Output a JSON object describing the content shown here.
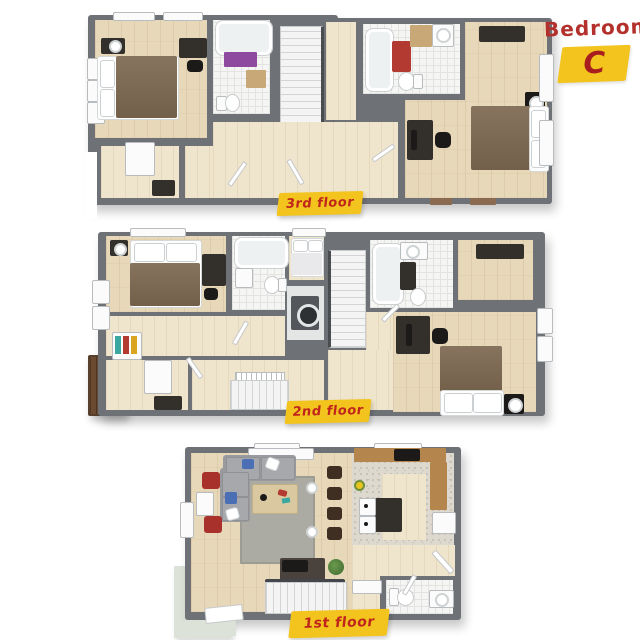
{
  "title": {
    "name": "Bedroom",
    "letter": "C"
  },
  "floors": [
    {
      "label": "3rd floor",
      "rooms": [
        "bedroom",
        "bathroom",
        "stairs",
        "hallway",
        "closet",
        "bathroom",
        "bedroom"
      ],
      "furniture": [
        "double-bed",
        "nightstand",
        "lamp",
        "desk",
        "office-chair",
        "dresser",
        "bathtub",
        "shower-curtain",
        "toilet",
        "vanity",
        "sink",
        "bath-mat",
        "speaker",
        "double-bed"
      ]
    },
    {
      "label": "2nd floor",
      "rooms": [
        "bedroom",
        "bathroom",
        "daybed-nook",
        "laundry",
        "stairs",
        "hallway",
        "closet",
        "balcony",
        "bathroom",
        "bedroom"
      ],
      "furniture": [
        "double-bed",
        "nightstand",
        "lamp",
        "desk",
        "wardrobe",
        "bookshelf",
        "bathtub",
        "toilet",
        "sink",
        "washer",
        "daybed",
        "dresser",
        "speaker",
        "double-bed"
      ]
    },
    {
      "label": "1st floor",
      "rooms": [
        "living-room",
        "kitchen",
        "stairs",
        "half-bathroom",
        "entry"
      ],
      "furniture": [
        "sectional-sofa",
        "throw-pillows",
        "coffee-table",
        "rug",
        "armchair",
        "armchair",
        "media-console",
        "record-player",
        "floor-lamp",
        "bar-stool",
        "kitchen-counter",
        "stove",
        "kitchen-island",
        "oven",
        "fridge",
        "plant",
        "desk",
        "toilet",
        "sink",
        "entry-mat"
      ]
    }
  ],
  "colors": {
    "wall": "#6e7277",
    "wood_floor": "#e8d8ba",
    "tile": "#f5f5f3",
    "bed_brown": "#7d6850",
    "accent_red": "#a8322b",
    "shower_purple": "#8e4a9e",
    "label_bg": "#f2c41d",
    "label_text": "#c0251c",
    "sofa_gray": "#989a9e",
    "counter_tan": "#b5854e",
    "deck_brown": "#6d4b33",
    "entry_mat_sage": "#dce2d8"
  }
}
